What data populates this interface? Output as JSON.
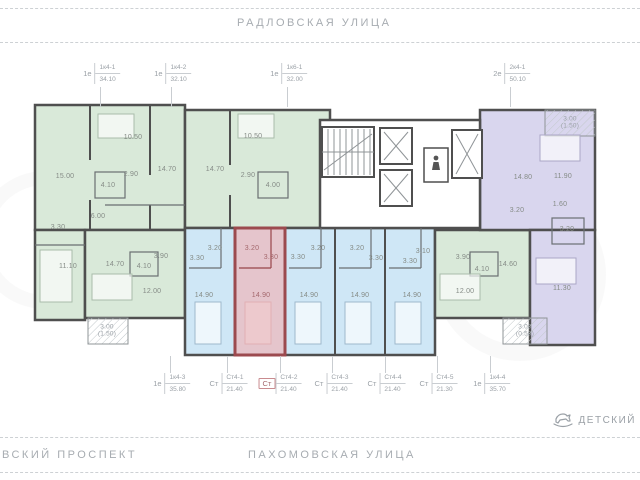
{
  "streets": {
    "top": "РАДЛОВСКАЯ  УЛИЦА",
    "bottom_left": "ВСКИЙ  ПРОСПЕКТ",
    "bottom_center": "ПАХОМОВСКАЯ  УЛИЦА"
  },
  "poi": {
    "label": "ДЕТСКИЙ",
    "icon": "rocking-horse-icon"
  },
  "plan": {
    "colors": {
      "wall": "#4f4f4f",
      "unit_green": "#d9e9d9",
      "unit_blue": "#cfe7f6",
      "unit_purple": "#d9d6ee",
      "highlight_fill": "#ecb9bd",
      "highlight_wall": "#9c4a4f",
      "muted_text": "#9aa0a6"
    },
    "callouts": [
      {
        "tier": "top",
        "x": 100,
        "type": "1е",
        "code": "1к4-1",
        "area": "34.10"
      },
      {
        "tier": "top",
        "x": 171,
        "type": "1е",
        "code": "1к4-2",
        "area": "32.10"
      },
      {
        "tier": "top",
        "x": 287,
        "type": "1е",
        "code": "1к6-1",
        "area": "32.00"
      },
      {
        "tier": "top",
        "x": 510,
        "type": "2е",
        "code": "2к4-1",
        "area": "50.10"
      },
      {
        "tier": "bottom",
        "x": 170,
        "type": "1е",
        "code": "1к4-3",
        "area": "35.80"
      },
      {
        "tier": "bottom",
        "x": 227,
        "type": "Ст",
        "code": "Ст4-1",
        "area": "21.40"
      },
      {
        "tier": "bottom",
        "x": 280,
        "type": "Ст",
        "code": "Ст4-2",
        "area": "21.40",
        "highlight": true
      },
      {
        "tier": "bottom",
        "x": 332,
        "type": "Ст",
        "code": "Ст4-3",
        "area": "21.40"
      },
      {
        "tier": "bottom",
        "x": 385,
        "type": "Ст",
        "code": "Ст4-4",
        "area": "21.40"
      },
      {
        "tier": "bottom",
        "x": 437,
        "type": "Ст",
        "code": "Ст4-5",
        "area": "21.30"
      },
      {
        "tier": "bottom",
        "x": 490,
        "type": "1е",
        "code": "1к4-4",
        "area": "35.70"
      }
    ],
    "rooms": [
      {
        "v": "15.00",
        "x": 65,
        "y": 177
      },
      {
        "v": "10.50",
        "x": 133,
        "y": 138
      },
      {
        "v": "4.10",
        "x": 108,
        "y": 186
      },
      {
        "v": "2.90",
        "x": 131,
        "y": 175
      },
      {
        "v": "14.70",
        "x": 167,
        "y": 170
      },
      {
        "v": "14.70",
        "x": 215,
        "y": 170
      },
      {
        "v": "10.50",
        "x": 253,
        "y": 137
      },
      {
        "v": "2.90",
        "x": 248,
        "y": 176
      },
      {
        "v": "4.00",
        "x": 273,
        "y": 186
      },
      {
        "v": "6.00",
        "x": 98,
        "y": 217
      },
      {
        "v": "3.30",
        "x": 58,
        "y": 228
      },
      {
        "v": "11.10",
        "x": 68,
        "y": 267
      },
      {
        "v": "14.70",
        "x": 115,
        "y": 265
      },
      {
        "v": "4.10",
        "x": 144,
        "y": 267
      },
      {
        "v": "3.90",
        "x": 161,
        "y": 257
      },
      {
        "v": "12.00",
        "x": 152,
        "y": 292
      },
      {
        "v": "3.30",
        "x": 197,
        "y": 259
      },
      {
        "v": "3.20",
        "x": 215,
        "y": 249
      },
      {
        "v": "14.90",
        "x": 204,
        "y": 296
      },
      {
        "v": "3.20",
        "x": 252,
        "y": 249,
        "tone": "red"
      },
      {
        "v": "3.30",
        "x": 271,
        "y": 258,
        "tone": "red"
      },
      {
        "v": "14.90",
        "x": 261,
        "y": 296,
        "tone": "red"
      },
      {
        "v": "3.30",
        "x": 298,
        "y": 258
      },
      {
        "v": "3.20",
        "x": 318,
        "y": 249
      },
      {
        "v": "14.90",
        "x": 309,
        "y": 296
      },
      {
        "v": "3.20",
        "x": 357,
        "y": 249
      },
      {
        "v": "3.30",
        "x": 376,
        "y": 259
      },
      {
        "v": "14.90",
        "x": 360,
        "y": 296
      },
      {
        "v": "3.30",
        "x": 410,
        "y": 262
      },
      {
        "v": "3.10",
        "x": 423,
        "y": 252
      },
      {
        "v": "14.90",
        "x": 412,
        "y": 296
      },
      {
        "v": "3.90",
        "x": 463,
        "y": 258
      },
      {
        "v": "4.10",
        "x": 482,
        "y": 270
      },
      {
        "v": "12.00",
        "x": 465,
        "y": 292
      },
      {
        "v": "14.60",
        "x": 508,
        "y": 265
      },
      {
        "v": "14.80",
        "x": 523,
        "y": 178
      },
      {
        "v": "11.90",
        "x": 563,
        "y": 177
      },
      {
        "v": "3.20",
        "x": 517,
        "y": 211
      },
      {
        "v": "1.60",
        "x": 560,
        "y": 205
      },
      {
        "v": "3.20",
        "x": 567,
        "y": 230
      },
      {
        "v": "11.30",
        "x": 562,
        "y": 289
      }
    ],
    "balconies": [
      {
        "x": 107,
        "y": 331,
        "lines": "3.00\n(1.50)"
      },
      {
        "x": 525,
        "y": 331,
        "lines": "3.00\n(0.50)"
      },
      {
        "x": 570,
        "y": 123,
        "lines": "3.00\n(1.50)"
      }
    ]
  }
}
